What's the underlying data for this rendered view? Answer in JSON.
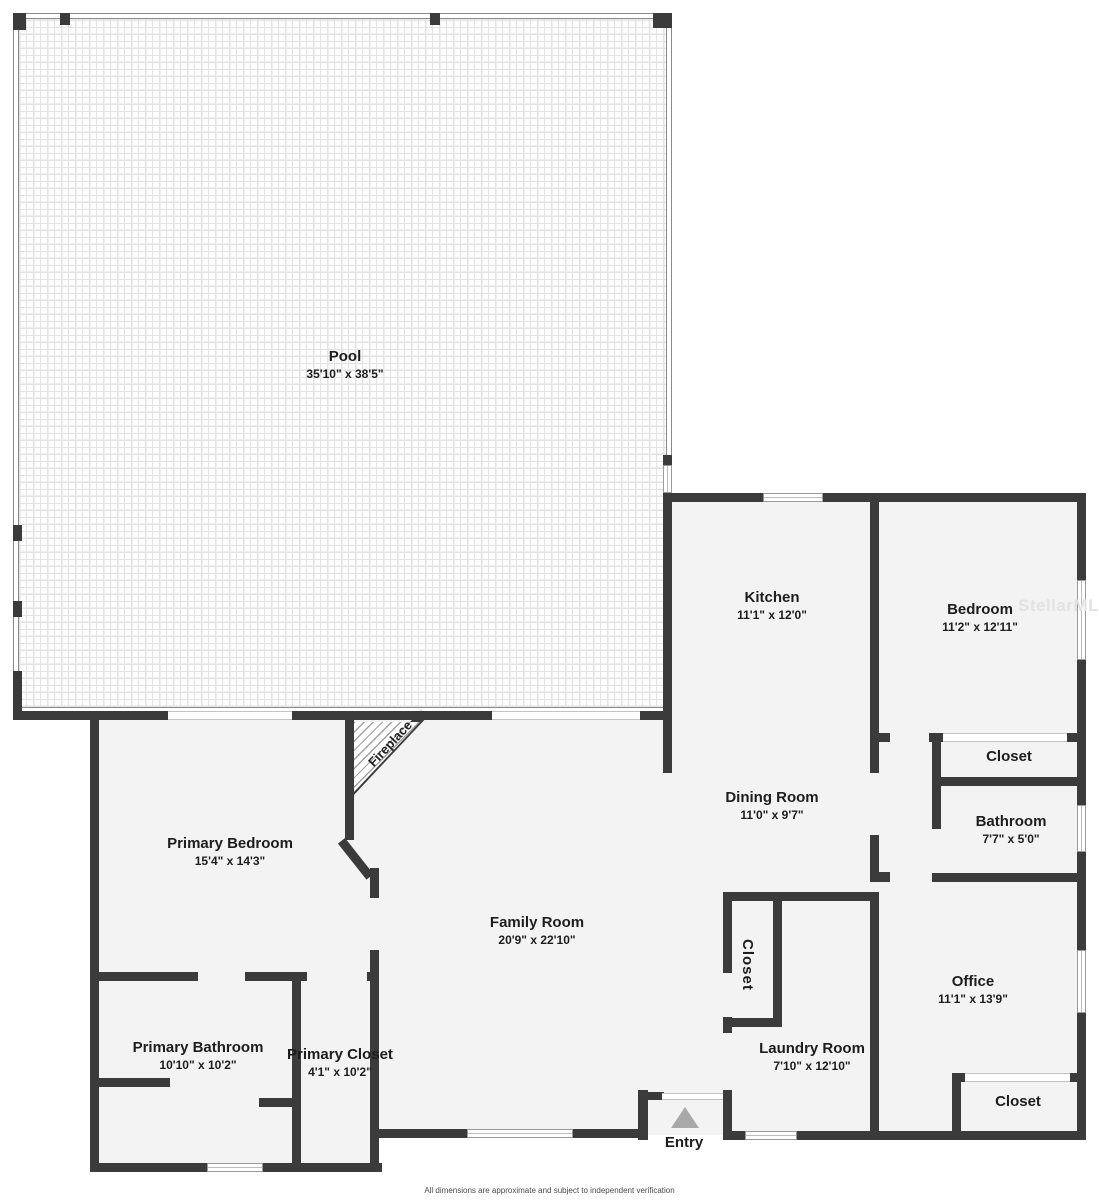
{
  "plan_title": "Residential floor plan",
  "watermark": "StellarMLS",
  "footer": {
    "disclaimer": "All dimensions are approximate and subject to independent verification"
  },
  "colors": {
    "wall": "#3b3b3b",
    "floor": "#f3f3f3",
    "background": "#ffffff",
    "pool_tile_line": "#e3e3e3",
    "entry_arrow": "#a8a8a8",
    "watermark": "#e2e2e2",
    "label_text": "#1d1d1d"
  },
  "rooms": {
    "pool": {
      "name": "Pool",
      "dims": "35'10\" x 38'5\""
    },
    "kitchen": {
      "name": "Kitchen",
      "dims": "11'1\" x 12'0\""
    },
    "bedroom": {
      "name": "Bedroom",
      "dims": "11'2\" x 12'11\""
    },
    "bedroom_closet": {
      "name": "Closet"
    },
    "bathroom": {
      "name": "Bathroom",
      "dims": "7'7\" x 5'0\""
    },
    "dining_room": {
      "name": "Dining Room",
      "dims": "11'0\" x 9'7\""
    },
    "primary_bedroom": {
      "name": "Primary Bedroom",
      "dims": "15'4\" x 14'3\""
    },
    "family_room": {
      "name": "Family Room",
      "dims": "20'9\" x 22'10\""
    },
    "office": {
      "name": "Office",
      "dims": "11'1\" x 13'9\""
    },
    "laundry_room": {
      "name": "Laundry Room",
      "dims": "7'10\" x 12'10\""
    },
    "hall_closet": {
      "name": "Closet"
    },
    "office_closet": {
      "name": "Closet"
    },
    "primary_bathroom": {
      "name": "Primary Bathroom",
      "dims": "10'10\" x 10'2\""
    },
    "primary_closet": {
      "name": "Primary Closet",
      "dims": "4'1\" x 10'2\""
    },
    "fireplace": {
      "name": "Fireplace"
    },
    "entry": {
      "name": "Entry"
    }
  }
}
